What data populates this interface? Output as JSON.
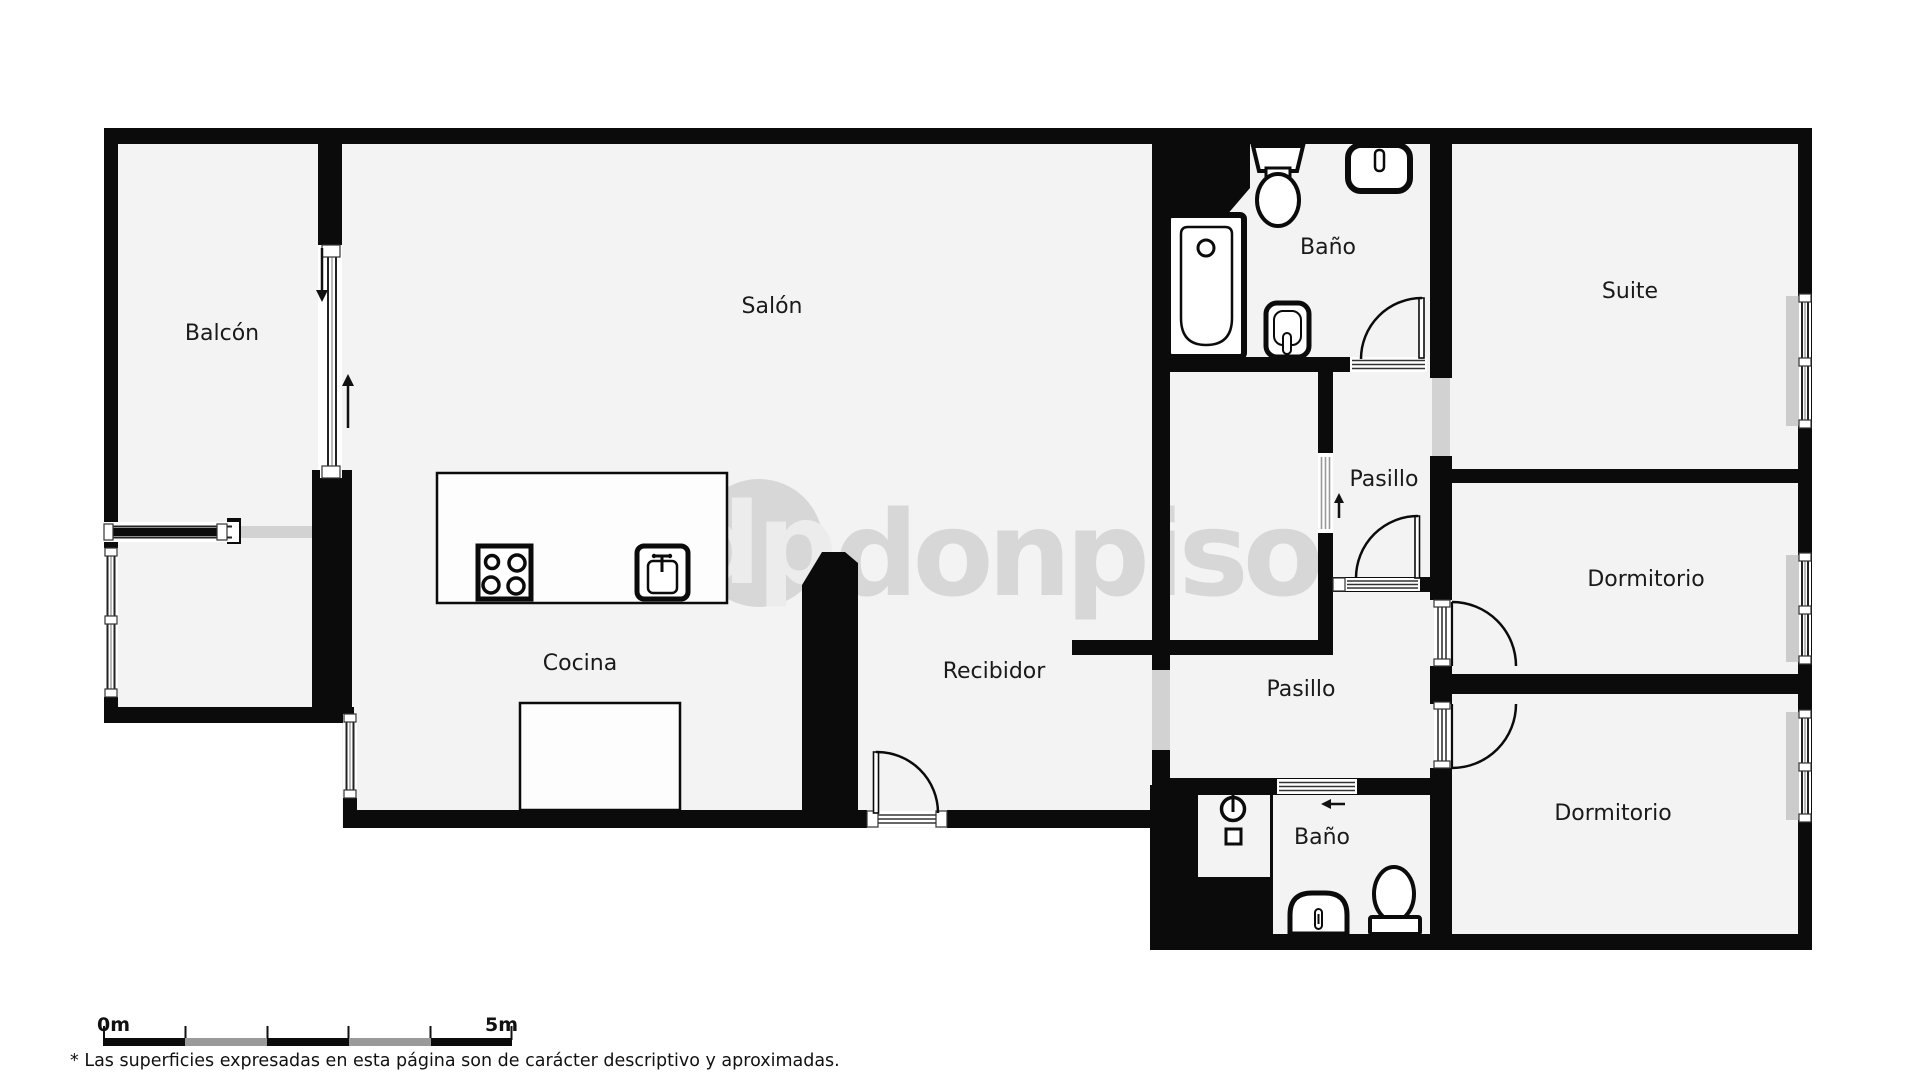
{
  "labels": {
    "balcon": "Balcón",
    "salon": "Salón",
    "cocina": "Cocina",
    "recibidor": "Recibidor",
    "bano_top": "Baño",
    "bano_bottom": "Baño",
    "pasillo_top": "Pasillo",
    "pasillo_bottom": "Pasillo",
    "suite": "Suite",
    "dormitorio_mid": "Dormitorio",
    "dormitorio_bottom": "Dormitorio"
  },
  "watermark": {
    "initials": "dp",
    "brand": "donpiso"
  },
  "scale_bar": {
    "start": "0m",
    "end": "5m"
  },
  "footnote": "* Las superficies expresadas en esta página son de carácter descriptivo y aproximadas.",
  "colors": {
    "wall": "#0b0b0b",
    "floor": "#f3f3f3",
    "outside": "#ffffff",
    "watermark": "#d7d7d7",
    "watermark_initials": "#ececec",
    "opening_gray": "#d2d2d2",
    "sill_gray": "#cccccc",
    "label": "#1a1a1a",
    "scale_gray": "#9a9a9a"
  },
  "icons": [
    "bathtub-icon",
    "toilet-icon",
    "handbasin-icon",
    "bidet-icon",
    "stove-icon",
    "kitchen-sink-icon",
    "washbasin-icon",
    "shower-tray-icon",
    "water-heater-icon",
    "door-swing-icon",
    "window-icon",
    "direction-arrow-icon"
  ]
}
